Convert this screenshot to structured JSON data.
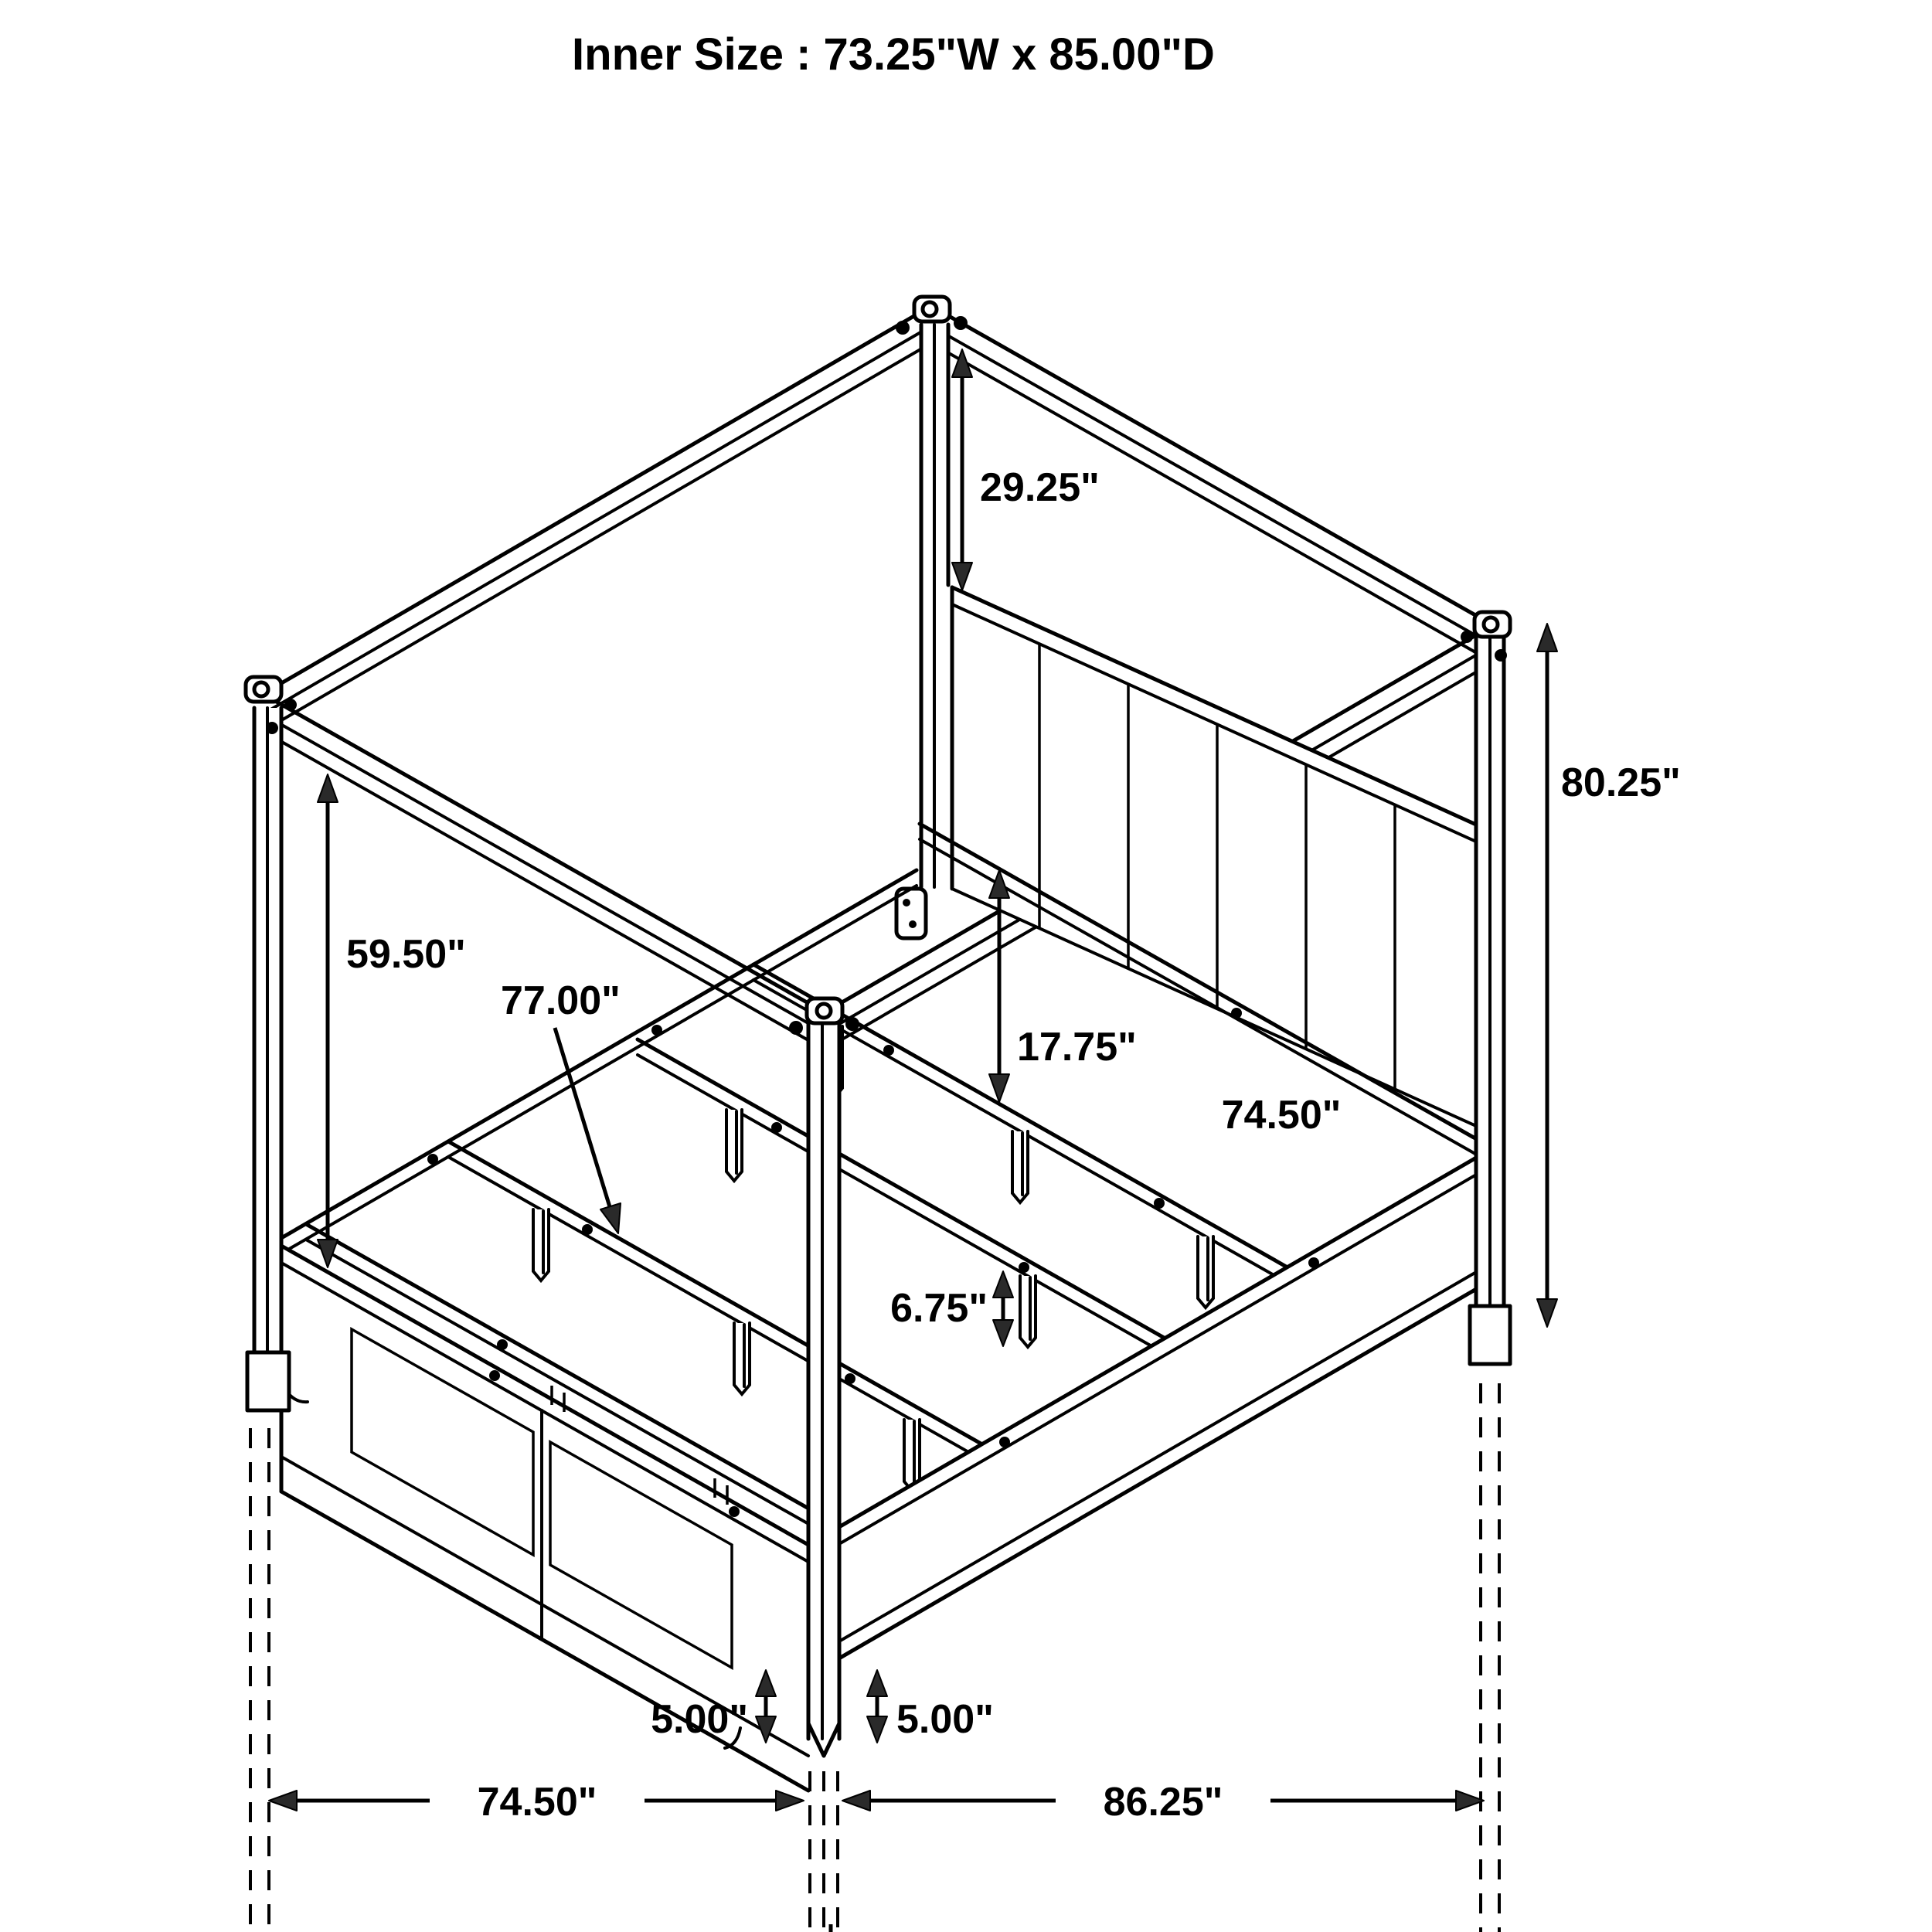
{
  "title": "Inner Size : 73.25\"W x 85.00\"D",
  "annotations": {
    "post_above_headboard": "29.25\"",
    "canopy_to_base": "59.50\"",
    "slat_rail_length": "77.00\"",
    "rail_height": "17.75\"",
    "headboard_side_length": "74.50\"",
    "overall_height": "80.25\"",
    "support_leg_height": "6.75\"",
    "left_foot_height": "5.00\"",
    "right_foot_height": "5.00\"",
    "base_width": "74.50\"",
    "base_depth": "86.25\"",
    "overall_width": "79.50\"",
    "overall_depth": "91.00\""
  },
  "colors": {
    "line": "#000000",
    "arrowhead": "#2a2a2a",
    "background": "#ffffff"
  },
  "drawing": {
    "type": "isometric-furniture-dimension-diagram",
    "subject": "four-poster canopy storage bed"
  }
}
